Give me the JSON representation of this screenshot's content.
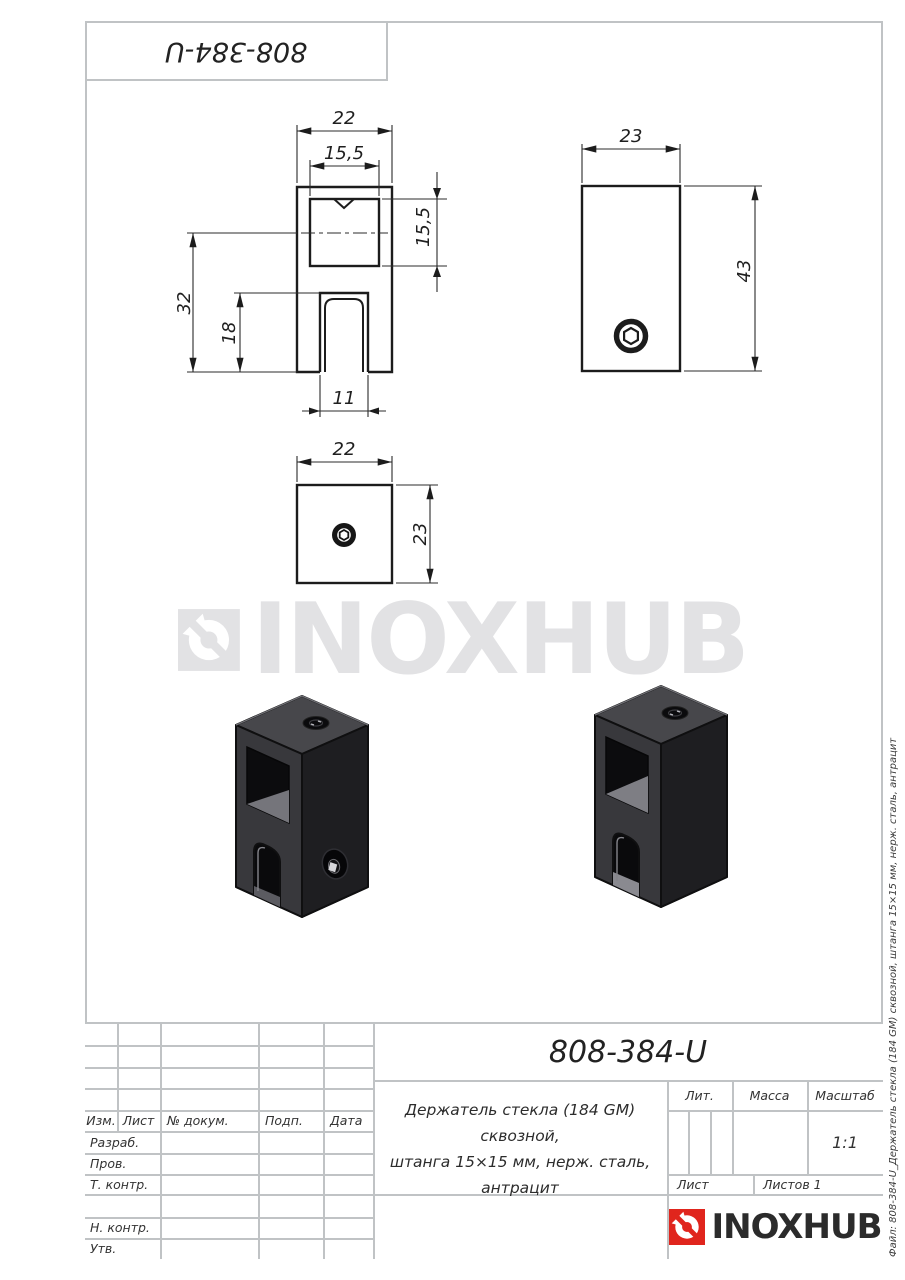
{
  "sheet": {
    "top_code": "808-384-U",
    "watermark_text": "INOXHUB",
    "file_note": "Файл: 808-384-U_Держатель стекла (184 GM) сквозной, штанга 15×15 мм, нерж. сталь, антрацит"
  },
  "views": {
    "front": {
      "w": "22",
      "hole": "15,5",
      "hole_side": "15,5",
      "to_axis": "32",
      "slot_depth": "18",
      "slot_w": "11"
    },
    "side": {
      "w": "23",
      "h": "43"
    },
    "top": {
      "w": "22",
      "d": "23"
    }
  },
  "title_block": {
    "code": "808-384-U",
    "desc1": "Держатель стекла (184 GM) сквозной,",
    "desc2": "штанга 15×15 мм, нерж. сталь, антрацит",
    "col_izm": "Изм.",
    "col_list": "Лист",
    "col_doc": "№ докум.",
    "col_sign": "Подп.",
    "col_date": "Дата",
    "row_razrab": "Разраб.",
    "row_prov": "Пров.",
    "row_tkontr": "Т. контр.",
    "row_nkontr": "Н. контр.",
    "row_utv": "Утв.",
    "lit": "Лит.",
    "mass": "Масса",
    "scale": "Масштаб",
    "scale_val": "1:1",
    "sheet_label": "Лист",
    "sheets_label": "Листов 1",
    "brand": "INOXHUB"
  },
  "colors": {
    "accent_red": "#e0251d",
    "frame_gray": "#c0c3c5",
    "line_black": "#1c1c1c",
    "watermark_gray": "#e2e2e4"
  }
}
